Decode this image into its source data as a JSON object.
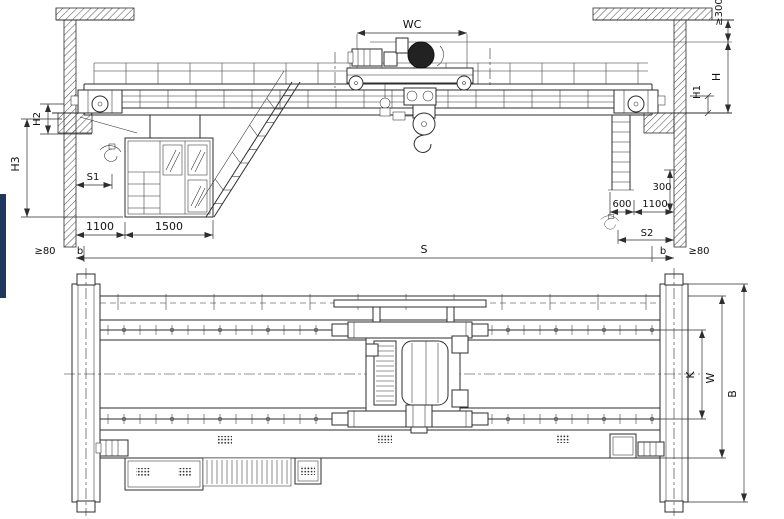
{
  "colors": {
    "line": "#2e2e2e",
    "background": "#ffffff",
    "accent_bar": "#20365c"
  },
  "elev": {
    "wc": "WC",
    "top_clearance": "≥300",
    "h": "H",
    "h1": "H1",
    "h2": "H2",
    "h3": "H3",
    "s1": "S1",
    "s2": "S2",
    "span": "S",
    "dim_1100_left": "1100",
    "dim_1500": "1500",
    "dim_600": "600",
    "dim_1100_right": "1100",
    "dim_300": "300",
    "b_left": "b",
    "b_right": "b",
    "clear_80_left": "≥80",
    "clear_80_right": "≥80"
  },
  "plan": {
    "k": "K",
    "w": "W",
    "b": "B"
  }
}
